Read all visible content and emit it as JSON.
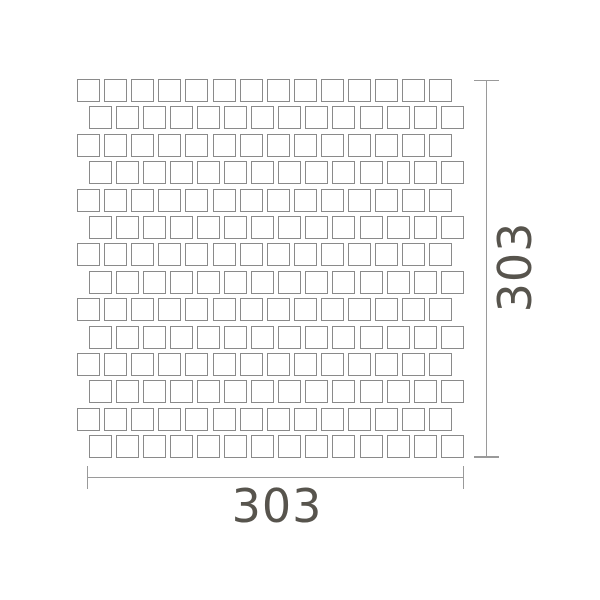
{
  "drawing": {
    "type": "mosaic-tile-sheet-dimension-drawing",
    "dimensions": {
      "width": {
        "value": "303"
      },
      "height": {
        "value": "303"
      }
    },
    "mosaic": {
      "rows": 14,
      "columns": 14,
      "tile_shape": "square",
      "pattern": "staggered-offset-rows",
      "layout": {
        "top": 79,
        "left_plain_row": 77,
        "left_offset_row": 88.6,
        "row_pitch": 27.4,
        "col_pitch": 27.1,
        "tile_size": 23
      }
    },
    "colors": {
      "background": "#ffffff",
      "tile_border": "#8a8a8a",
      "dimension_line": "#9a9a9a",
      "label_text": "#57544d"
    }
  }
}
